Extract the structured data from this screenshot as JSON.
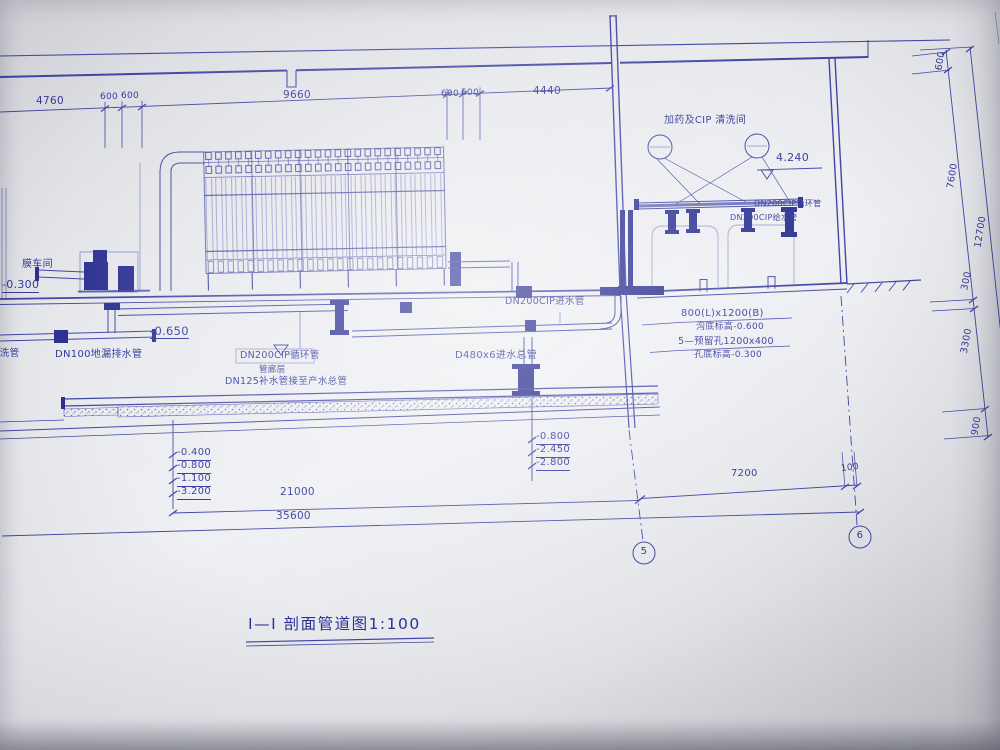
{
  "title": "I—I 剖面管道图1:100",
  "labels": {
    "membrane_hall": "膜车间",
    "cip_room": "加药及CIP 清洗间",
    "gallery_level": "管廊层",
    "air_wash_pipe": "气洗管",
    "floor_drain_pipe": "DN100地漏排水管",
    "cip_circulation_mid": "DN200CIP循环管",
    "makeup_pipe": "DN125补水管接至产水总管",
    "cip_inlet_pipe": "DN200CIP进水管",
    "main_inlet_pipe": "D480x6进水总管",
    "cip_circulation_right": "DN200CIP循环管",
    "cip_supply_right": "DN200CIP给水管"
  },
  "elevations": {
    "hall_floor": "-0.300",
    "trench": "-0.650",
    "cip_pipe_level": "4.240",
    "left_stack": [
      "-0.400",
      "-0.800",
      "-1.100",
      "-3.200"
    ],
    "right_stack": [
      "-0.800",
      "-2.450",
      "-2.800"
    ]
  },
  "dimensions": {
    "top": [
      "4760",
      "600",
      "600",
      "9660",
      "600",
      "600",
      "4440"
    ],
    "right": [
      "600",
      "7600",
      "12700",
      "300",
      "3300",
      "900"
    ],
    "bottom": [
      "21000",
      "35600",
      "7200",
      "100"
    ]
  },
  "notes": {
    "trench_size": "800(L)x1200(B)",
    "trench_bottom": "沟底标高-0.600",
    "reserved_holes": "5—预留孔1200x400",
    "hole_bottom": "孔底标高-0.300"
  },
  "grid": {
    "g5": "5",
    "g6": "6"
  }
}
